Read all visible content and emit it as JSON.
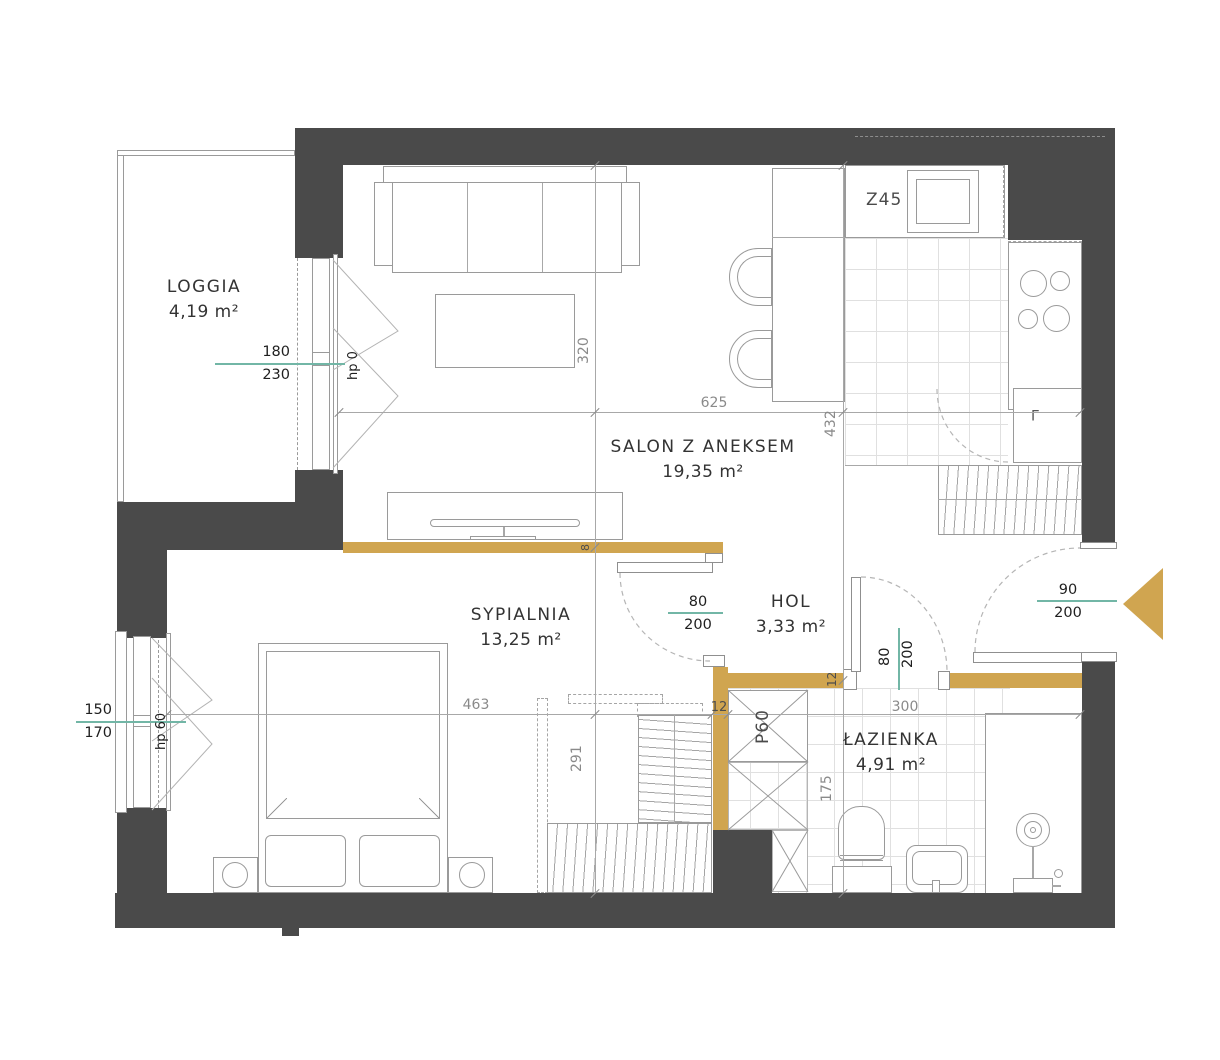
{
  "title": "Apartment floor plan",
  "colors": {
    "wall": "#4a4a4a",
    "partition": "#d0a550",
    "dimension_line": "#72b6a6"
  },
  "rooms": {
    "loggia": {
      "name": "LOGGIA",
      "area": "4,19 m²"
    },
    "salon": {
      "name": "SALON Z ANEKSEM",
      "area": "19,35 m²"
    },
    "sypialnia": {
      "name": "SYPIALNIA",
      "area": "13,25 m²"
    },
    "hol": {
      "name": "HOL",
      "area": "3,33 m²"
    },
    "lazienka": {
      "name": "ŁAZIENKA",
      "area": "4,91 m²"
    }
  },
  "openings": {
    "balcony_door": {
      "width": "180",
      "height": "230",
      "sill": "hp 0"
    },
    "bedroom_window": {
      "width": "150",
      "height": "170",
      "sill": "hp 60"
    },
    "entrance_door": {
      "width": "90",
      "height": "200"
    },
    "bedroom_door": {
      "width": "80",
      "height": "200"
    },
    "bathroom_door": {
      "width": "80",
      "height": "200"
    }
  },
  "dims": {
    "salon_width": "625",
    "salon_depth": "320",
    "kitchen_depth": "432",
    "bedroom_width": "463",
    "bedroom_depth": "291",
    "bath_width": "300",
    "bath_depth": "175",
    "wall_hol": "12",
    "wall_bath": "12",
    "wall_partition": "8"
  },
  "labels": {
    "shaft": "P60",
    "kitchen_unit": "Z45",
    "fridge": "L"
  }
}
